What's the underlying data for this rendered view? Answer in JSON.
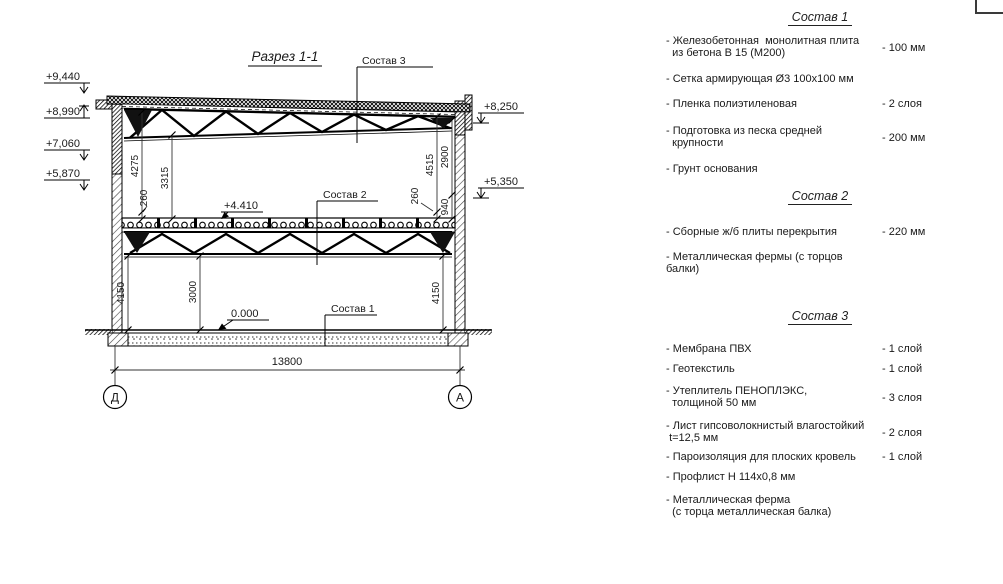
{
  "drawing": {
    "title": "Разрез 1-1",
    "callouts": {
      "c1": "Состав 1",
      "c2": "Состав 2",
      "c3": "Состав 3"
    },
    "elev": {
      "l1": "+9,440",
      "l2": "+8,990",
      "l3": "+7,060",
      "l4": "+5,870",
      "r1": "+8,250",
      "r2": "+5,350",
      "mid": "+4.410",
      "zero": "0.000"
    },
    "dims": {
      "ul_a": "4275",
      "ul_b": "3315",
      "ul_c": "260",
      "ur_a": "4515",
      "ur_b": "2900",
      "ur_c": "940",
      "ur_d": "260",
      "ll_a": "4150",
      "ll_b": "3000",
      "lr_a": "4150",
      "width": "13800"
    },
    "axes": {
      "left": "Д",
      "right": "А"
    }
  },
  "specs": [
    {
      "title": "Состав 1",
      "items": [
        {
          "name": "- Железобетонная  монолитная плита\n  из бетона В 15 (М200)",
          "value": "- 100 мм"
        },
        {
          "name": "- Сетка армирующая Ø3 100х100 мм",
          "value": ""
        },
        {
          "name": "- Пленка полиэтиленовая",
          "value": "- 2 слоя"
        },
        {
          "name": "- Подготовка из песка средней\n  крупности",
          "value": "- 200 мм"
        },
        {
          "name": "- Грунт основания",
          "value": ""
        }
      ]
    },
    {
      "title": "Состав 2",
      "items": [
        {
          "name": "- Сборные ж/б плиты перекрытия",
          "value": "- 220 мм"
        },
        {
          "name": "- Металлическая фермы (с торцов балки)",
          "value": ""
        }
      ]
    },
    {
      "title": "Состав 3",
      "items": [
        {
          "name": "- Мембрана ПВХ",
          "value": "- 1 слой"
        },
        {
          "name": "- Геотекстиль",
          "value": "- 1 слой"
        },
        {
          "name": "- Утеплитель ПЕНОПЛЭКС,\n  толщиной 50 мм",
          "value": "- 3 слоя"
        },
        {
          "name": "- Лист гипсоволокнистый влагостойкий\n t=12,5 мм",
          "value": "- 2 слоя"
        },
        {
          "name": "- Пароизоляция для плоских кровель",
          "value": "- 1 слой"
        },
        {
          "name": "- Профлист Н 114х0,8 мм",
          "value": ""
        },
        {
          "name": "- Металлическая ферма\n  (с торца металлическая балка)",
          "value": ""
        }
      ]
    }
  ]
}
